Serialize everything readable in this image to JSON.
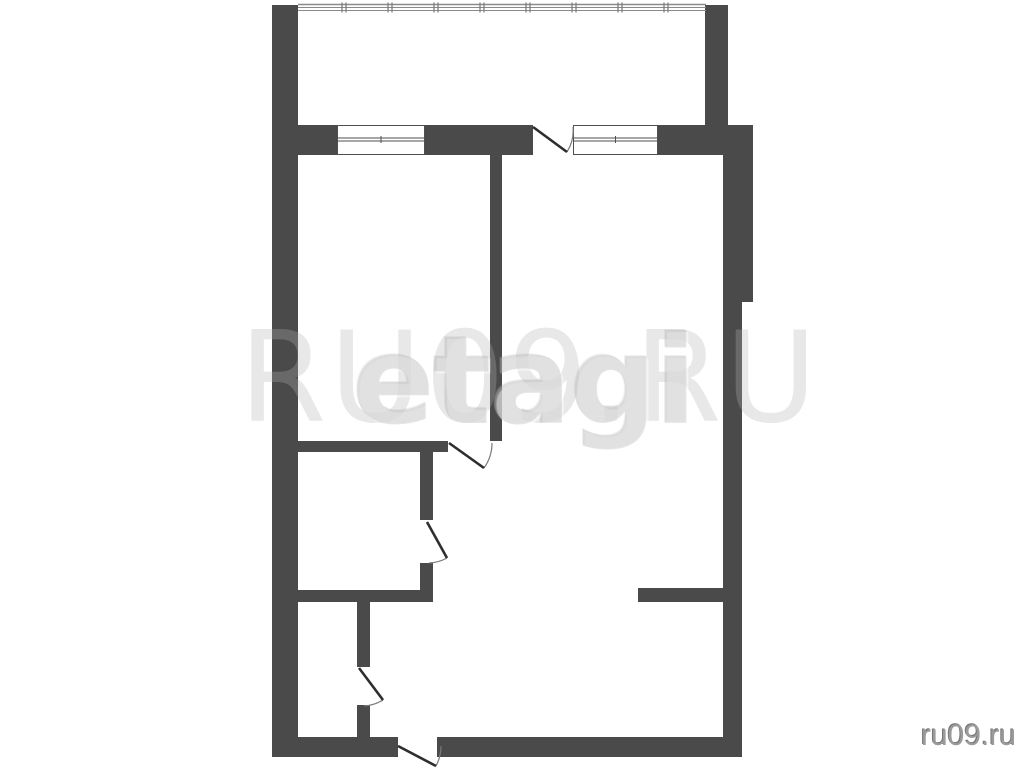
{
  "watermark": {
    "back_text": "RU09.RU",
    "front_text": "etagi",
    "corner_text": "ru09.ru"
  },
  "colors": {
    "background": "#ffffff",
    "wall": "#4a4a4a",
    "window_line": "#4f4f4f",
    "glazing_line": "#8a8a8a",
    "glazing_tick": "#7d7d7d",
    "door_leaf": "#2e2e2e",
    "door_arc": "#7a7a7a",
    "corner_text": "#9b9b9b"
  },
  "plan": {
    "canvas": {
      "width": 1024,
      "height": 768
    },
    "walls": [
      {
        "name": "wall-left-outer",
        "rect": [
          272,
          5,
          26,
          752
        ]
      },
      {
        "name": "wall-balcony-right",
        "rect": [
          705,
          5,
          23,
          120
        ]
      },
      {
        "name": "wall-window-left-segment",
        "rect": [
          298,
          125,
          39,
          30
        ]
      },
      {
        "name": "wall-window-mid-segment",
        "rect": [
          425,
          125,
          108,
          30
        ]
      },
      {
        "name": "wall-window-right-segment",
        "rect": [
          658,
          125,
          95,
          30
        ]
      },
      {
        "name": "wall-right-upper",
        "rect": [
          723,
          125,
          30,
          177
        ]
      },
      {
        "name": "wall-right-lower",
        "rect": [
          723,
          302,
          19,
          455
        ]
      },
      {
        "name": "wall-room-divider",
        "rect": [
          490,
          155,
          12,
          286
        ]
      },
      {
        "name": "wall-bathroom-top",
        "rect": [
          293,
          441,
          155,
          11
        ]
      },
      {
        "name": "wall-bathroom-right-upper",
        "rect": [
          420,
          452,
          13,
          68
        ]
      },
      {
        "name": "wall-bathroom-right-lower",
        "rect": [
          420,
          563,
          13,
          39
        ]
      },
      {
        "name": "wall-bathroom-bottom",
        "rect": [
          293,
          590,
          140,
          12
        ]
      },
      {
        "name": "wall-hall-upper",
        "rect": [
          357,
          602,
          13,
          65
        ]
      },
      {
        "name": "wall-hall-lower",
        "rect": [
          357,
          705,
          13,
          32
        ]
      },
      {
        "name": "wall-living-stub",
        "rect": [
          638,
          588,
          85,
          14
        ]
      },
      {
        "name": "wall-bottom-left",
        "rect": [
          272,
          737,
          126,
          20
        ]
      },
      {
        "name": "wall-bottom-right",
        "rect": [
          437,
          737,
          305,
          20
        ]
      }
    ],
    "windows": [
      {
        "name": "window-bedroom",
        "rect": [
          337,
          125,
          88,
          30
        ]
      },
      {
        "name": "window-living",
        "rect": [
          573,
          125,
          85,
          30
        ]
      }
    ],
    "balcony_glazing": {
      "x1": 298,
      "x2": 706,
      "y_lines": [
        4.5,
        7.5,
        10.5
      ],
      "tick_start": 342,
      "tick_step": 46,
      "tick_count": 8,
      "tick_y1": 2.5,
      "tick_y2": 12.5
    },
    "doors": [
      {
        "name": "door-balcony",
        "leaf": [
          533,
          127,
          567,
          152
        ],
        "arc": "M573 127 A40 40 0 0 1 567 152"
      },
      {
        "name": "door-bedroom",
        "leaf": [
          449,
          443,
          484,
          468
        ],
        "arc": "M492 443 A43 43 0 0 1 484 468"
      },
      {
        "name": "door-bathroom",
        "leaf": [
          427,
          522,
          447,
          558
        ],
        "arc": "M447 558 A41 41 0 0 1 429 563"
      },
      {
        "name": "door-hall",
        "leaf": [
          359,
          668,
          383,
          700
        ],
        "arc": "M383 700 A40 40 0 0 1 364 706"
      },
      {
        "name": "door-entrance",
        "leaf": [
          398,
          746,
          436,
          766
        ],
        "arc": "M441 746 A43 43 0 0 1 436 766"
      }
    ]
  }
}
